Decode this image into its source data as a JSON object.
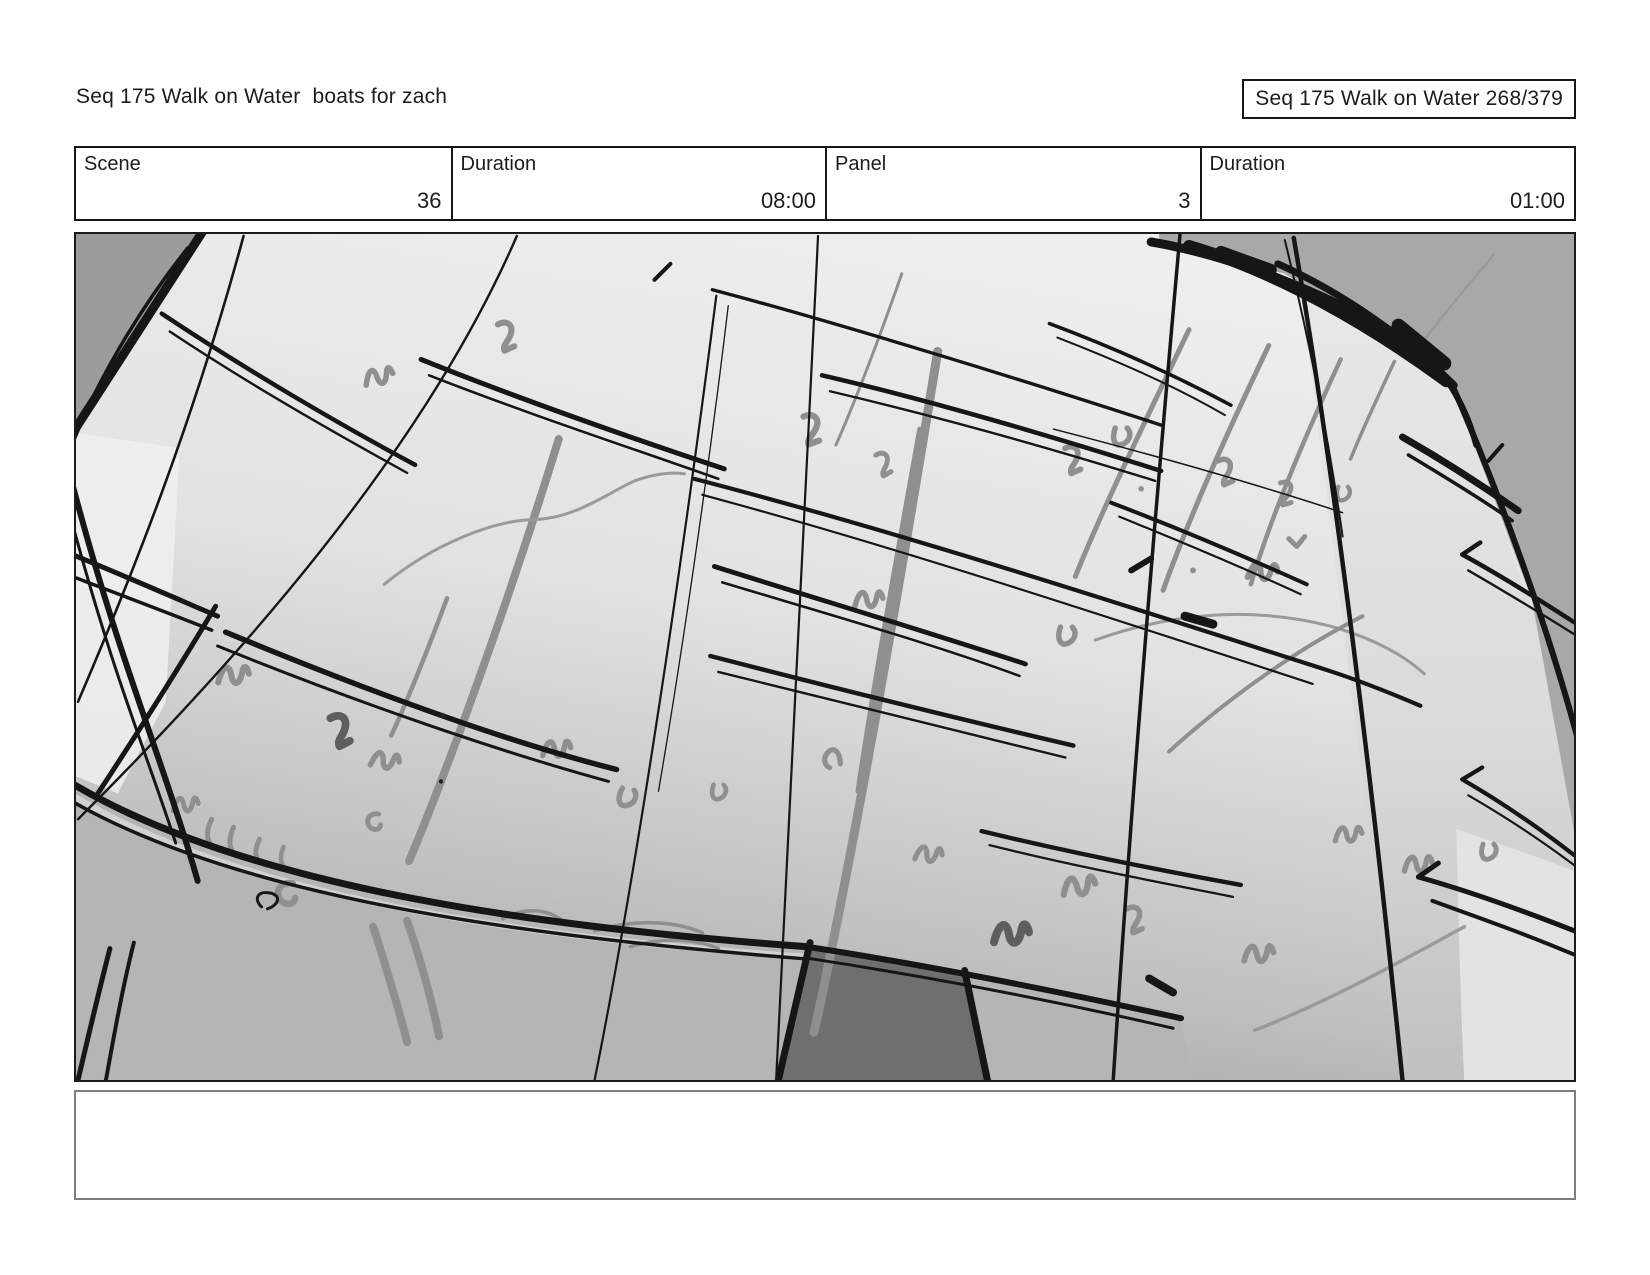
{
  "header": {
    "title": "Seq 175 Walk on Water  boats for zach",
    "page_indicator": "Seq 175 Walk on Water 268/379"
  },
  "info_table": {
    "cells": [
      {
        "label": "Scene",
        "value": "36"
      },
      {
        "label": "Duration",
        "value": "08:00"
      },
      {
        "label": "Panel",
        "value": "3"
      },
      {
        "label": "Duration",
        "value": "01:00"
      }
    ]
  },
  "panel": {
    "type": "storyboard-sketch",
    "description": "Hand-drawn perspective sketch of terraced field rows seen from above: black sketchy row lines on converging columns, gray grass-tuft scribbles, gray background corners, foreground bank and a dark post at bottom center",
    "colors": {
      "field_light": "#ededed",
      "field_dark": "#a5a5a5",
      "outside_gray": "#a8a8a8",
      "corner_gray": "#9c9c9c",
      "bank_gray": "#b5b5b5",
      "post_gray": "#6f6f6f",
      "ink": "#161616",
      "pencil_gray": "#8f8f8f"
    }
  },
  "notes": {
    "text": ""
  }
}
